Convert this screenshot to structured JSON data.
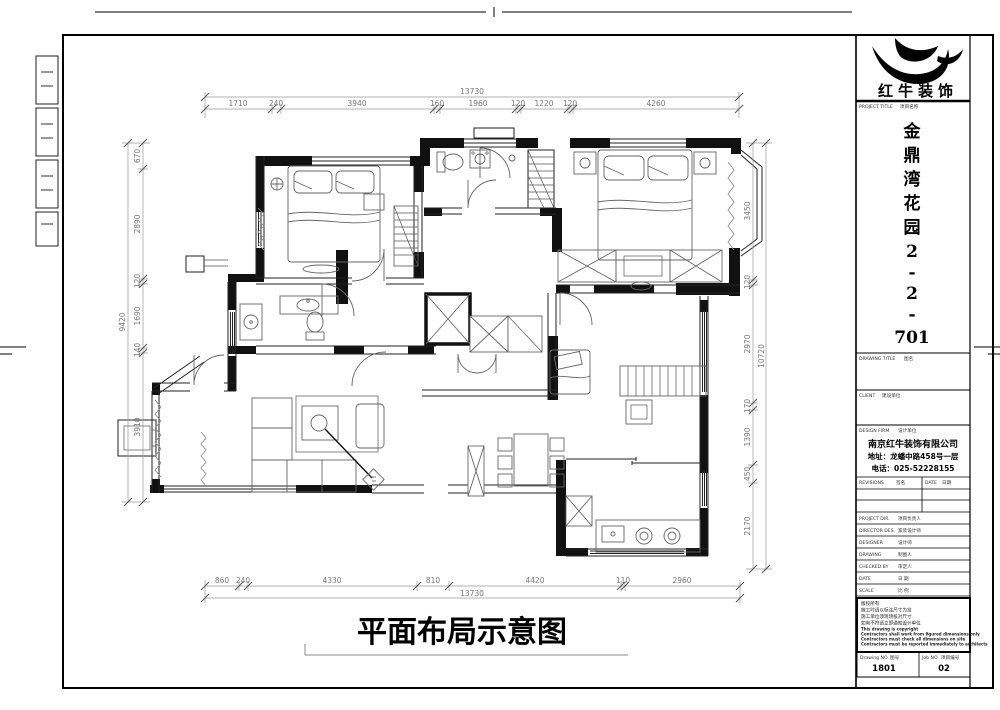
{
  "sheet": {
    "caption": "平面布局示意图",
    "brand": {
      "name": "红牛装饰"
    },
    "colors": {
      "line": "#111111",
      "dim_line": "#999999",
      "paper": "#ffffff"
    },
    "title_block": {
      "project_label_en": "PROJECT TITLE",
      "project_label_cn": "项目名称",
      "project_name_chars": [
        "金",
        "鼎",
        "湾",
        "花",
        "园",
        "2",
        "-",
        "2",
        "-",
        "701"
      ],
      "drawing_title_en": "DRAWING TITLE",
      "drawing_title_cn": "图名",
      "client_en": "CLIENT",
      "client_cn": "建设单位",
      "design_firm_en": "DESIGN FIRM",
      "design_firm_cn": "设计单位",
      "firm_name": "南京红牛装饰有限公司",
      "firm_address": "地址：龙蟠中路458号一层",
      "firm_phone": "电话：025-52228155",
      "revisions_en": "REVISIONS",
      "revisions_cn": "签名",
      "date_col_en": "DATE",
      "date_col_cn": "日期",
      "rows": [
        {
          "en": "PROJECT DIR.",
          "cn": "项目负责人"
        },
        {
          "en": "DIRECTOR DES.",
          "cn": "家装设计师"
        },
        {
          "en": "DESIGNER",
          "cn": "设计师"
        },
        {
          "en": "DRAWING",
          "cn": "制图人"
        },
        {
          "en": "CHECKED BY",
          "cn": "审定人"
        },
        {
          "en": "DATE",
          "cn": "日 期"
        },
        {
          "en": "SCALE",
          "cn": "比 例"
        }
      ],
      "notes": [
        "版权所有",
        "施工时请以标注尺寸为准",
        "施工单位须现场核对尺寸",
        "如有不符请立即通知设计单位",
        "This drawing is copyright",
        "Contractors shall work from figured dimensions only",
        "Contractors must check all dimensions on site",
        "Contractors must be reported immediately to architects"
      ],
      "drawing_no_en": "Drawing NO",
      "drawing_no_cn": "图号",
      "job_no_en": "Job NO",
      "job_no_cn": "项目编号",
      "drawing_no_value": "1801",
      "job_no_value": "02"
    },
    "dims": {
      "top": {
        "overall": "13730",
        "segments": [
          "1710",
          "240",
          "3940",
          "160",
          "1960",
          "120",
          "1220",
          "120",
          "4260"
        ]
      },
      "bottom": {
        "overall": "13730",
        "segments": [
          "860",
          "240",
          "4330",
          "810",
          "4420",
          "110",
          "2960"
        ]
      },
      "left": {
        "overall": "9420",
        "segments": [
          "670",
          "2890",
          "120",
          "1690",
          "140",
          "3910"
        ]
      },
      "right": {
        "overall": "10720",
        "segments": [
          "3450",
          "120",
          "2970",
          "170",
          "1390",
          "450",
          "2170"
        ]
      }
    }
  }
}
